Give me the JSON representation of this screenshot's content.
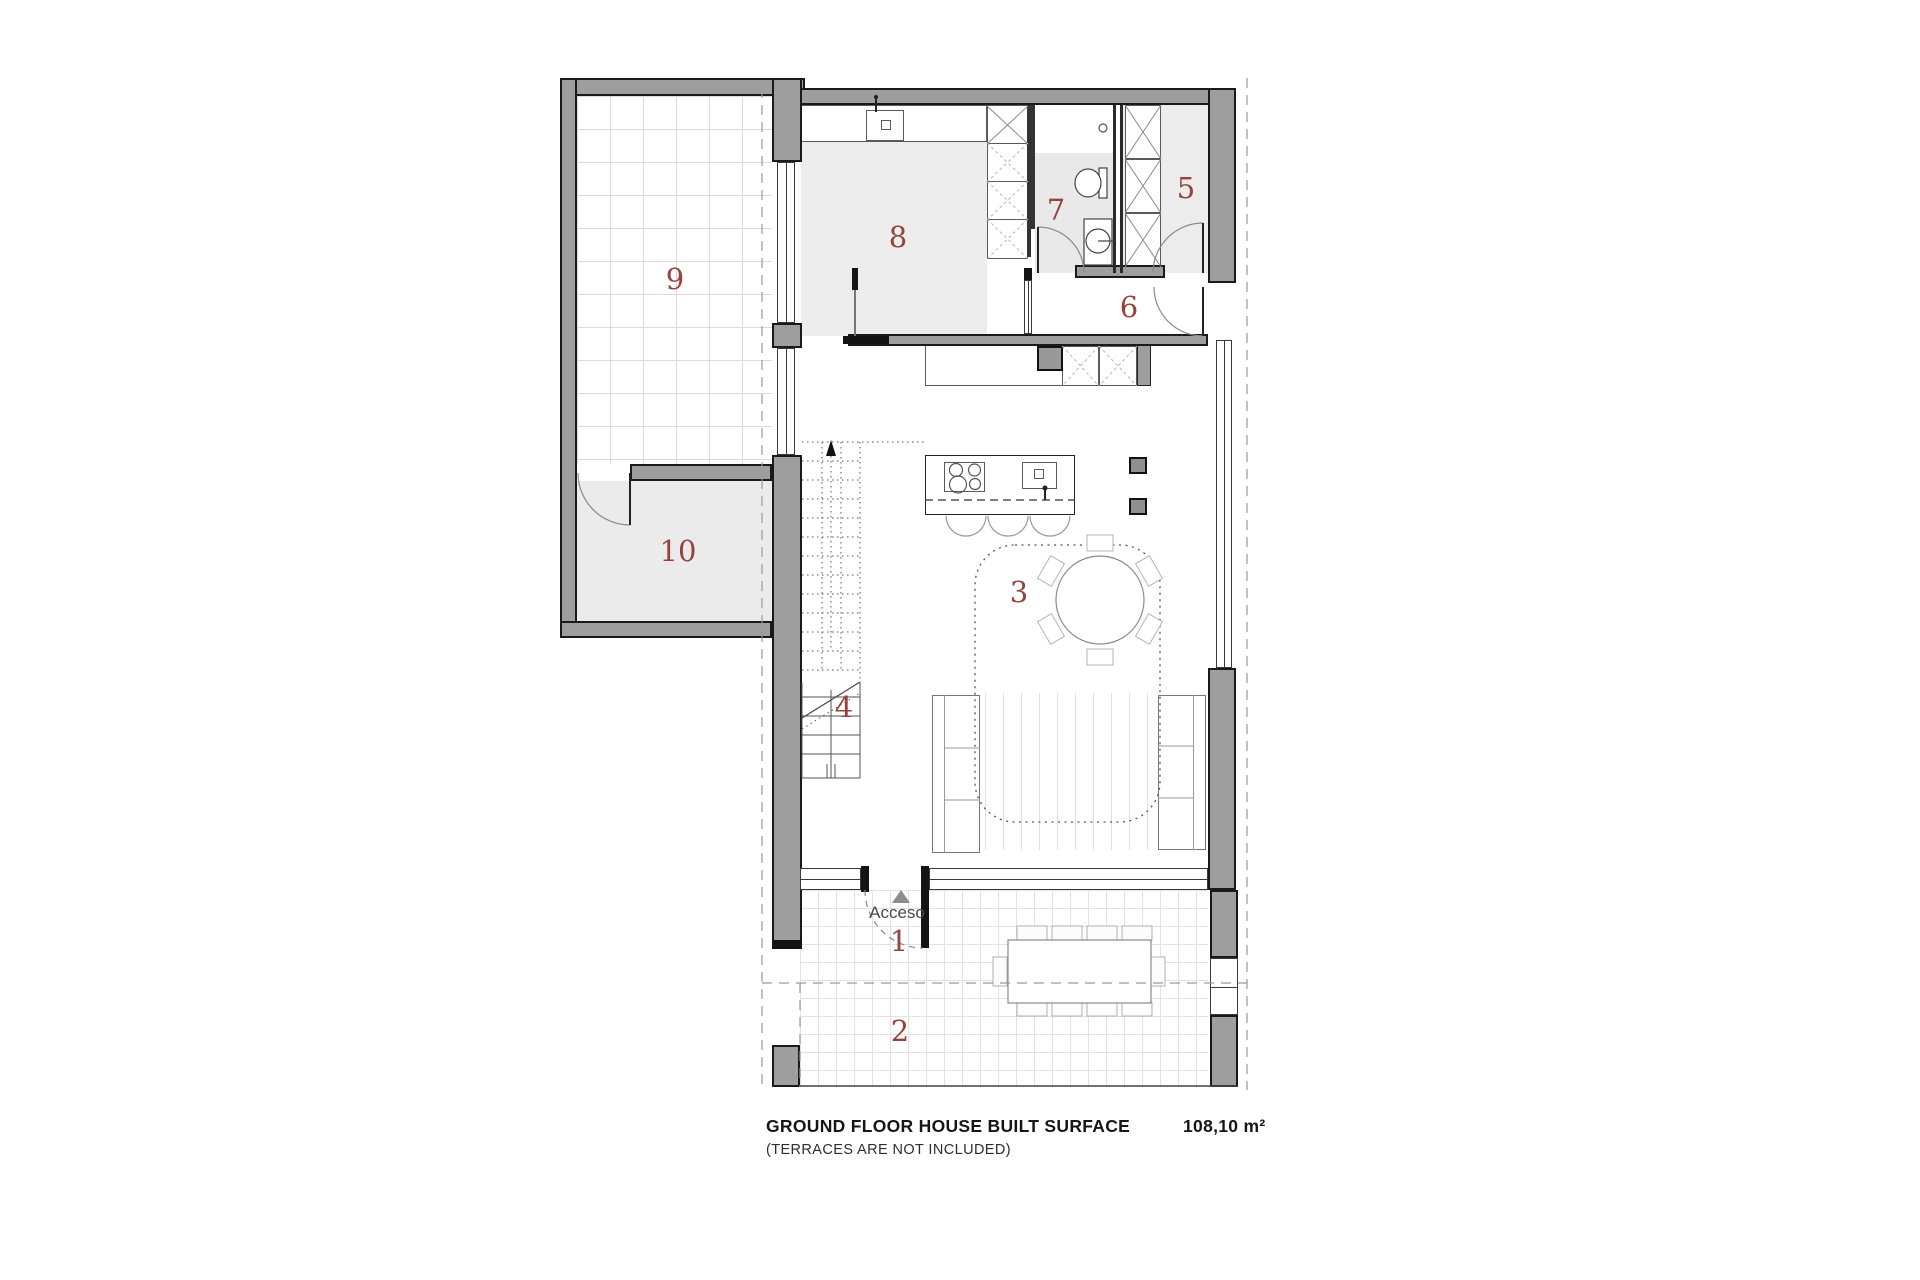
{
  "plan": {
    "entrance_label": "Acceso",
    "room_numbers": [
      "1",
      "2",
      "3",
      "4",
      "5",
      "6",
      "7",
      "8",
      "9",
      "10"
    ]
  },
  "caption": {
    "title": "GROUND FLOOR HOUSE BUILT SURFACE",
    "subtitle": "(TERRACES ARE NOT INCLUDED)",
    "area": "108,10 m²"
  },
  "colors": {
    "wall": "#9e9e9e",
    "room_label": "#94443c",
    "floor_light": "#ededed",
    "terrace_grid": "#dadada"
  }
}
